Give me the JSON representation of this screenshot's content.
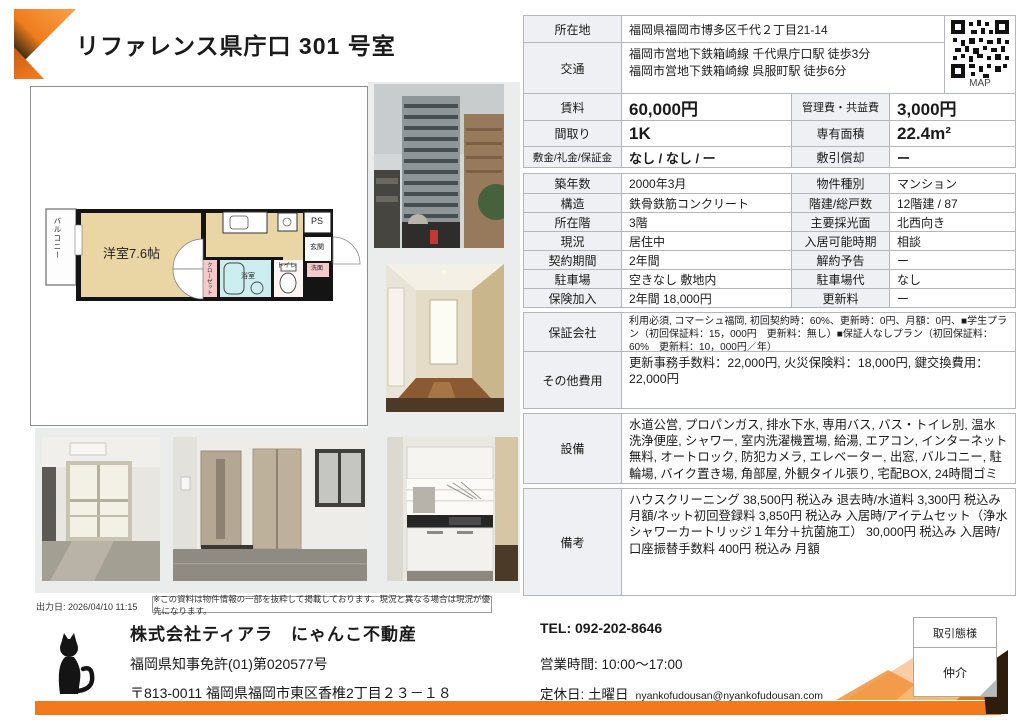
{
  "page": {
    "title": "リファレンス県庁口 301 号室"
  },
  "colors": {
    "accent_orange": "#f4791d",
    "room_tan": "#e9d6a4",
    "bath_cyan": "#cdeef0",
    "pink": "#f6caca"
  },
  "map_label": "MAP",
  "floorplan": {
    "balcony": "バルコニー",
    "main_room": "洋室7.6帖",
    "closet": "クローゼット",
    "bath": "浴室",
    "toilet": "トイレ",
    "washroom": "洗面",
    "entrance": "玄関",
    "ps": "PS"
  },
  "table": {
    "location": {
      "label": "所在地",
      "value": "福岡県福岡市博多区千代２丁目21-14"
    },
    "access": {
      "label": "交通",
      "value": "福岡市営地下鉄箱崎線 千代県庁口駅 徒歩3分\n福岡市営地下鉄箱崎線 呉服町駅 徒歩6分"
    },
    "pairs": [
      {
        "l1": "賃料",
        "v1": "60,000円",
        "l2": "管理費・共益費",
        "v2": "3,000円"
      },
      {
        "l1": "間取り",
        "v1": "1K",
        "l2": "専有面積",
        "v2": "22.4m²"
      },
      {
        "l1": "敷金/礼金/保証金",
        "v1": "なし / なし / ー",
        "l2": "敷引償却",
        "v2": "ー"
      },
      {
        "l1": "築年数",
        "v1": "2000年3月",
        "l2": "物件種別",
        "v2": "マンション"
      },
      {
        "l1": "構造",
        "v1": "鉄骨鉄筋コンクリート",
        "l2": "階建/総戸数",
        "v2": "12階建 / 87"
      },
      {
        "l1": "所在階",
        "v1": "3階",
        "l2": "主要採光面",
        "v2": "北西向き"
      },
      {
        "l1": "現況",
        "v1": "居住中",
        "l2": "入居可能時期",
        "v2": "相談"
      },
      {
        "l1": "契約期間",
        "v1": "2年間",
        "l2": "解約予告",
        "v2": "ー"
      },
      {
        "l1": "駐車場",
        "v1": "空きなし 敷地内",
        "l2": "駐車場代",
        "v2": "なし"
      },
      {
        "l1": "保険加入",
        "v1": "2年間 18,000円",
        "l2": "更新料",
        "v2": "ー"
      }
    ],
    "guarantor": {
      "label": "保証会社",
      "value": "利用必須, コマーシュ福岡, 初回契約時：60%、更新時：0円、月額：0円、■学生プラン（初回保証料：15，000円　更新料：無し）■保証人なしプラン（初回保証料：60%　更新料：10，000円／年）"
    },
    "other_fees": {
      "label": "その他費用",
      "value": "更新事務手数料：22,000円, 火災保険料：18,000円, 鍵交換費用：22,000円"
    },
    "equipment": {
      "label": "設備",
      "value": "水道公営, プロパンガス, 排水下水, 専用バス, バス・トイレ別, 温水洗浄便座, シャワー, 室内洗濯機置場, 給湯, エアコン, インターネット無料, オートロック, 防犯カメラ, エレベーター, 出窓, バルコニー, 駐輪場, バイク置き場, 角部屋, 外観タイル張り, 宅配BOX, 24時間ゴミ出し可, ペット相談, 単身限定"
    },
    "notes": {
      "label": "備考",
      "value": "ハウスクリーニング 38,500円 税込み 退去時/水道料 3,300円 税込み 月額/ネット初回登録料 3,850円 税込み 入居時/アイテムセット（浄水シャワーカートリッジ１年分＋抗菌施工） 30,000円 税込み 入居時/口座振替手数料 400円 税込み 月額"
    }
  },
  "footer": {
    "output_date": "出力日: 2026/04/10 11:15",
    "disclaimer": "※この資料は物件情報の一部を抜粋して掲載しております。現況と異なる場合は現況が優先になります。",
    "company_name": "株式会社ティアラ　にゃんこ不動産",
    "license": "福岡県知事免許(01)第020577号",
    "address": "〒813-0011 福岡県福岡市東区香椎2丁目２３－１８",
    "tel": "TEL: 092-202-8646",
    "hours": "営業時間: 10:00～17:00",
    "closed": "定休日: 土曜日",
    "email": "nyankofudousan@nyankofudousan.com",
    "deal_type_label": "取引態様",
    "deal_type_value": "仲介"
  }
}
